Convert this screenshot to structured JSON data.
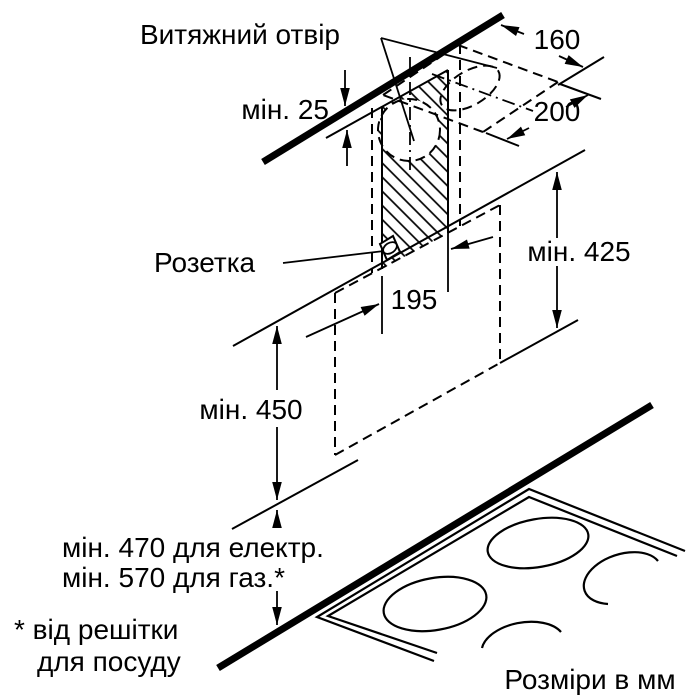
{
  "page": {
    "background": "#ffffff",
    "ink_color": "#000000"
  },
  "diagram": {
    "kind": "kitchen-hood-installation-drawing",
    "units_note": "Розміри в мм",
    "labels": {
      "exhaust_opening": "Витяжний отвір",
      "socket": "Розетка",
      "footnote_line1": "* від решітки",
      "footnote_line2": "для посуду"
    },
    "dimensions": {
      "gap_to_ceiling": "мін. 25",
      "opening_depth": "160",
      "opening_width": "200",
      "socket_offset": "195",
      "min_chimney_height": "мін. 425",
      "min_hood_height": "мін. 450",
      "electric_clearance": "мін. 470 для електр.",
      "gas_clearance": "мін. 570 для газ.*"
    }
  }
}
